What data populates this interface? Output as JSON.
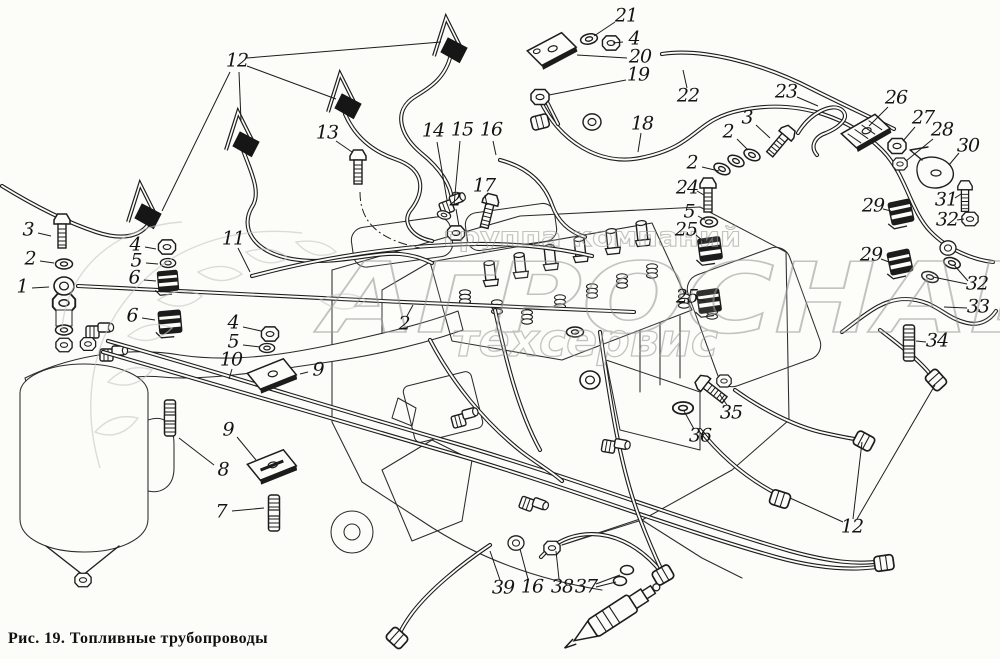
{
  "figure": {
    "caption": "Рис. 19. Топливные трубопроводы"
  },
  "watermark": {
    "line1": "группа компаний",
    "line2": "АГРОСНАБ",
    "line3": "техсервис"
  },
  "callouts": [
    {
      "label": "21",
      "x": 626,
      "y": 17,
      "leaders": [
        [
          615,
          22,
          594,
          36
        ]
      ]
    },
    {
      "label": "4",
      "x": 634,
      "y": 40,
      "leaders": [
        [
          623,
          42,
          613,
          43
        ]
      ]
    },
    {
      "label": "20",
      "x": 640,
      "y": 58,
      "leaders": [
        [
          627,
          58,
          577,
          55
        ]
      ]
    },
    {
      "label": "19",
      "x": 638,
      "y": 76,
      "leaders": [
        [
          626,
          80,
          549,
          95
        ]
      ]
    },
    {
      "label": "22",
      "x": 688,
      "y": 97,
      "leaders": [
        [
          687,
          88,
          683,
          70
        ]
      ]
    },
    {
      "label": "18",
      "x": 642,
      "y": 125,
      "leaders": [
        [
          641,
          133,
          638,
          152
        ]
      ]
    },
    {
      "label": "12",
      "x": 237,
      "y": 62,
      "leaders": [
        [
          247,
          58,
          441,
          42
        ],
        [
          247,
          66,
          336,
          99
        ],
        [
          239,
          72,
          241,
          121
        ],
        [
          230,
          72,
          162,
          211
        ]
      ]
    },
    {
      "label": "13",
      "x": 327,
      "y": 134,
      "leaders": [
        [
          336,
          141,
          352,
          152
        ]
      ]
    },
    {
      "label": "14",
      "x": 433,
      "y": 132,
      "leaders": [
        [
          437,
          142,
          447,
          200
        ]
      ]
    },
    {
      "label": "15",
      "x": 462,
      "y": 131,
      "leaders": [
        [
          460,
          141,
          454,
          205
        ]
      ]
    },
    {
      "label": "16",
      "x": 491,
      "y": 131,
      "leaders": [
        [
          493,
          141,
          496,
          155
        ]
      ]
    },
    {
      "label": "17",
      "x": 484,
      "y": 187,
      "leaders": [
        [
          485,
          195,
          487,
          205
        ]
      ]
    },
    {
      "label": "2",
      "x": 455,
      "y": 201,
      "leaders": [
        [
          456,
          209,
          459,
          226
        ]
      ]
    },
    {
      "label": "23",
      "x": 786,
      "y": 93,
      "leaders": [
        [
          797,
          97,
          818,
          106
        ]
      ]
    },
    {
      "label": "26",
      "x": 896,
      "y": 99,
      "leaders": [
        [
          888,
          107,
          869,
          126
        ]
      ]
    },
    {
      "label": "27",
      "x": 923,
      "y": 119,
      "leaders": [
        [
          915,
          127,
          903,
          141
        ]
      ]
    },
    {
      "label": "28",
      "x": 942,
      "y": 131,
      "leaders": [
        [
          933,
          139,
          906,
          161
        ]
      ]
    },
    {
      "label": "30",
      "x": 968,
      "y": 147,
      "leaders": [
        [
          959,
          153,
          949,
          165
        ]
      ]
    },
    {
      "label": "3",
      "x": 747,
      "y": 119,
      "leaders": [
        [
          756,
          125,
          770,
          138
        ]
      ]
    },
    {
      "label": "2",
      "x": 728,
      "y": 133,
      "leaders": [
        [
          737,
          139,
          748,
          150
        ]
      ]
    },
    {
      "label": "2",
      "x": 692,
      "y": 164,
      "leaders": [
        [
          702,
          167,
          719,
          171
        ]
      ]
    },
    {
      "label": "24",
      "x": 687,
      "y": 189,
      "leaders": [
        [
          697,
          191,
          704,
          195
        ]
      ]
    },
    {
      "label": "5",
      "x": 689,
      "y": 213,
      "leaders": [
        [
          698,
          216,
          705,
          220
        ]
      ]
    },
    {
      "label": "25",
      "x": 686,
      "y": 231,
      "leaders": [
        [
          696,
          235,
          704,
          242
        ]
      ]
    },
    {
      "label": "25",
      "x": 687,
      "y": 298,
      "leaders": [
        [
          697,
          299,
          705,
          301
        ]
      ]
    },
    {
      "label": "29",
      "x": 873,
      "y": 207,
      "leaders": [
        [
          883,
          209,
          891,
          211
        ]
      ]
    },
    {
      "label": "29",
      "x": 871,
      "y": 256,
      "leaders": [
        [
          881,
          259,
          889,
          262
        ]
      ]
    },
    {
      "label": "31",
      "x": 946,
      "y": 201,
      "leaders": [
        [
          955,
          198,
          961,
          194
        ]
      ]
    },
    {
      "label": "32",
      "x": 947,
      "y": 221,
      "leaders": [
        [
          957,
          220,
          964,
          219
        ]
      ]
    },
    {
      "label": "32",
      "x": 977,
      "y": 285,
      "leaders": [
        [
          968,
          281,
          954,
          265
        ],
        [
          967,
          284,
          933,
          277
        ]
      ]
    },
    {
      "label": "33",
      "x": 978,
      "y": 308,
      "leaders": [
        [
          967,
          308,
          944,
          307
        ]
      ]
    },
    {
      "label": "34",
      "x": 937,
      "y": 342,
      "leaders": [
        [
          926,
          342,
          916,
          341
        ]
      ]
    },
    {
      "label": "11",
      "x": 233,
      "y": 240,
      "leaders": [
        [
          238,
          248,
          250,
          272
        ]
      ]
    },
    {
      "label": "3",
      "x": 28,
      "y": 231,
      "leaders": [
        [
          38,
          233,
          51,
          236
        ]
      ]
    },
    {
      "label": "2",
      "x": 30,
      "y": 260,
      "leaders": [
        [
          40,
          261,
          54,
          263
        ]
      ]
    },
    {
      "label": "1",
      "x": 22,
      "y": 288,
      "leaders": [
        [
          32,
          288,
          49,
          287
        ]
      ]
    },
    {
      "label": "4",
      "x": 135,
      "y": 246,
      "leaders": [
        [
          145,
          247,
          156,
          249
        ]
      ]
    },
    {
      "label": "5",
      "x": 136,
      "y": 262,
      "leaders": [
        [
          146,
          263,
          158,
          264
        ]
      ]
    },
    {
      "label": "6",
      "x": 134,
      "y": 279,
      "leaders": [
        [
          144,
          280,
          156,
          281
        ]
      ]
    },
    {
      "label": "6",
      "x": 132,
      "y": 317,
      "leaders": [
        [
          142,
          318,
          155,
          320
        ]
      ]
    },
    {
      "label": "4",
      "x": 233,
      "y": 324,
      "leaders": [
        [
          243,
          327,
          261,
          331
        ]
      ]
    },
    {
      "label": "5",
      "x": 233,
      "y": 343,
      "leaders": [
        [
          243,
          345,
          260,
          347
        ]
      ]
    },
    {
      "label": "10",
      "x": 231,
      "y": 361,
      "leaders": [
        [
          232,
          369,
          229,
          379
        ]
      ]
    },
    {
      "label": "9",
      "x": 318,
      "y": 371,
      "leaders": [
        [
          308,
          372,
          300,
          374
        ]
      ]
    },
    {
      "label": "9",
      "x": 228,
      "y": 431,
      "leaders": [
        [
          237,
          437,
          256,
          460
        ]
      ]
    },
    {
      "label": "8",
      "x": 223,
      "y": 471,
      "leaders": [
        [
          214,
          465,
          179,
          438
        ]
      ]
    },
    {
      "label": "7",
      "x": 221,
      "y": 513,
      "leaders": [
        [
          232,
          511,
          264,
          508
        ]
      ]
    },
    {
      "label": "2",
      "x": 404,
      "y": 325,
      "leaders": [
        [
          407,
          316,
          413,
          305
        ]
      ]
    },
    {
      "label": "35",
      "x": 731,
      "y": 414,
      "leaders": [
        [
          727,
          405,
          720,
          395
        ]
      ]
    },
    {
      "label": "36",
      "x": 700,
      "y": 437,
      "leaders": [
        [
          694,
          429,
          684,
          411
        ]
      ]
    },
    {
      "label": "39",
      "x": 503,
      "y": 589,
      "leaders": [
        [
          500,
          580,
          490,
          551
        ]
      ]
    },
    {
      "label": "16",
      "x": 532,
      "y": 588,
      "leaders": [
        [
          528,
          579,
          520,
          549
        ]
      ]
    },
    {
      "label": "38",
      "x": 562,
      "y": 588,
      "leaders": [
        [
          559,
          579,
          556,
          551
        ]
      ]
    },
    {
      "label": "37",
      "x": 586,
      "y": 588,
      "leaders": [
        [
          596,
          584,
          620,
          575
        ],
        [
          596,
          587,
          616,
          582
        ]
      ]
    },
    {
      "label": "12",
      "x": 852,
      "y": 528,
      "leaders": [
        [
          857,
          519,
          935,
          385
        ],
        [
          853,
          519,
          862,
          442
        ],
        [
          843,
          522,
          790,
          498
        ]
      ]
    }
  ]
}
